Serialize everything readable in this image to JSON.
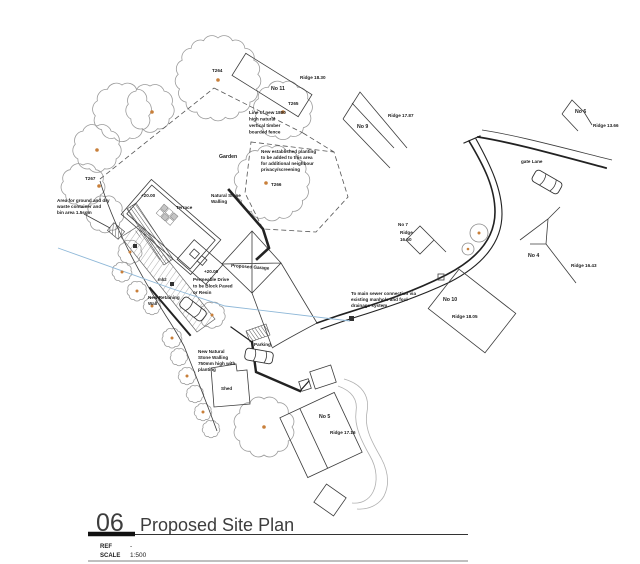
{
  "title_block": {
    "number": "06",
    "title": "Proposed Site Plan",
    "ref_label": "REF",
    "ref_value": "-",
    "scale_label": "SCALE",
    "scale_value": "1:500"
  },
  "colors": {
    "linework": "#3c3c3c",
    "tree_outline": "#9b9b9b",
    "tree_dot_orange": "#c87f3a",
    "drainage_blue": "#8fb8d8"
  },
  "plan": {
    "tree_tags": [
      "T264",
      "T265",
      "T266",
      "T267"
    ],
    "levels": {
      "house": "+20.00",
      "drive": "+20.00"
    },
    "manholes": {
      "mh2": "mh2"
    },
    "areas": {
      "garden": "Garden",
      "terrace": "Terrace",
      "shed": "Shed",
      "parking": "Parking",
      "garage": "Proposed Garage",
      "lane": "gate Lane"
    },
    "buildings": [
      {
        "name": "No 11",
        "ridge": "Ridge 18.30"
      },
      {
        "name": "No 9",
        "ridge": "Ridge 17.87"
      },
      {
        "name": "No 6",
        "ridge": "Ridge 13.66"
      },
      {
        "name": "No 7",
        "ridge": "Ridge",
        "ridge2": "16.50"
      },
      {
        "name": "No 4",
        "ridge": "Ridge 16.43"
      },
      {
        "name": "No 10",
        "ridge": "Ridge 18.05"
      },
      {
        "name": "No 5",
        "ridge": "Ridge 17.16"
      }
    ],
    "notes": {
      "fence": [
        "Line of new 1800",
        "high natural",
        "vertical timber",
        "boarded fence"
      ],
      "planting": [
        "New established planting",
        "to be added to this area",
        "for additional neighbour",
        "privacy/screening"
      ],
      "waste": [
        "Area for ground and dry",
        "waste container and",
        "bin area 1.5sqm"
      ],
      "stone_walling": [
        "Natural Stone",
        "Walling"
      ],
      "drive": [
        "Permeable Drive",
        "to be Block Paved",
        "or Resin"
      ],
      "retaining": [
        "New Retaining",
        "Wall"
      ],
      "new_stone_wall": [
        "New Natural",
        "Stone Walling",
        "750mm high with",
        "planting"
      ],
      "sewer": [
        "To main sewer connection via",
        "existing manhole and foul",
        "drainage system"
      ]
    }
  }
}
